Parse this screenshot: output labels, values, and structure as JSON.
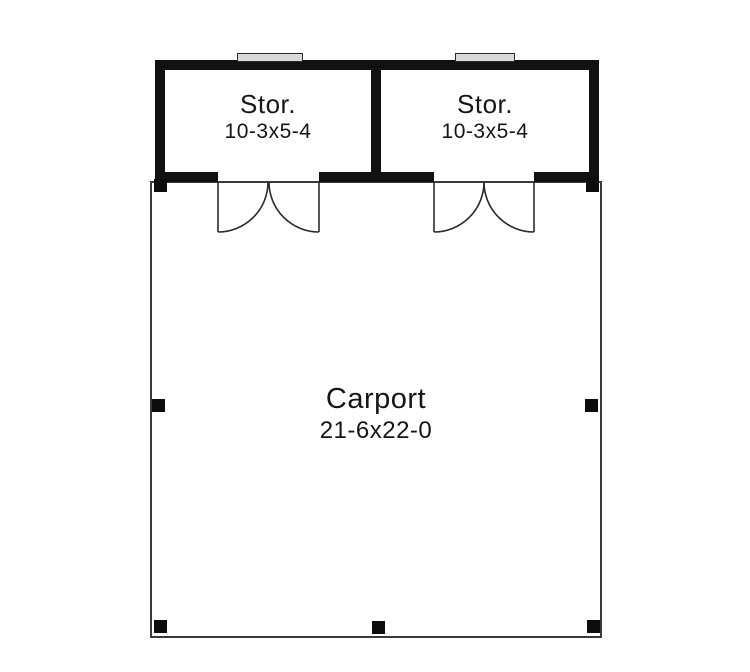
{
  "title": "Carport floor plan",
  "colors": {
    "background": "#ffffff",
    "wall": "#111111",
    "outline": "#3a3a3a",
    "door": "#2b2b2b",
    "text": "#161616",
    "window_fill": "#d9d9d9",
    "window_border": "#2b2b2b",
    "post": "#0d0d0d"
  },
  "rooms": {
    "storage_left": {
      "label": "Stor.",
      "dimensions": "10-3x5-4"
    },
    "storage_right": {
      "label": "Stor.",
      "dimensions": "10-3x5-4"
    },
    "carport": {
      "label": "Carport",
      "dimensions": "21-6x22-0"
    }
  },
  "features": {
    "window_count": 2,
    "double_door_count": 2,
    "post_count": 7
  }
}
